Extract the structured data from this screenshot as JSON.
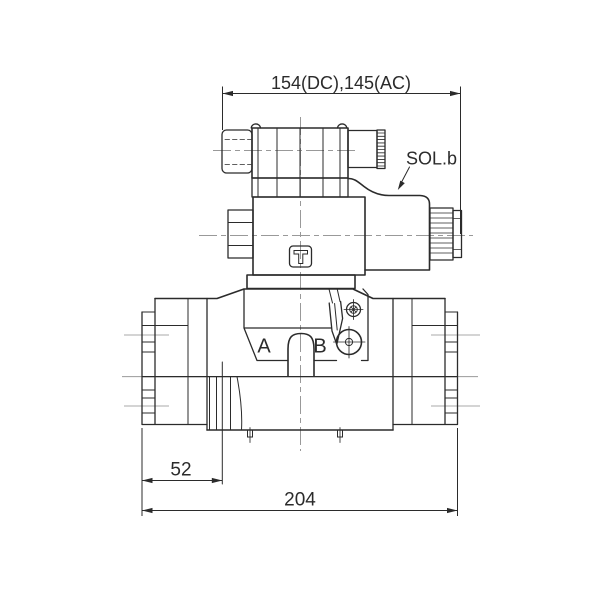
{
  "labels": {
    "top_dimension": "154(DC),145(AC)",
    "solenoid": "SOL.b",
    "port_a": "A",
    "port_b": "B",
    "dim_offset": "52",
    "dim_overall": "204"
  },
  "colors": {
    "line": "#2b2b2b",
    "centerline": "#999999",
    "background": "#ffffff"
  }
}
